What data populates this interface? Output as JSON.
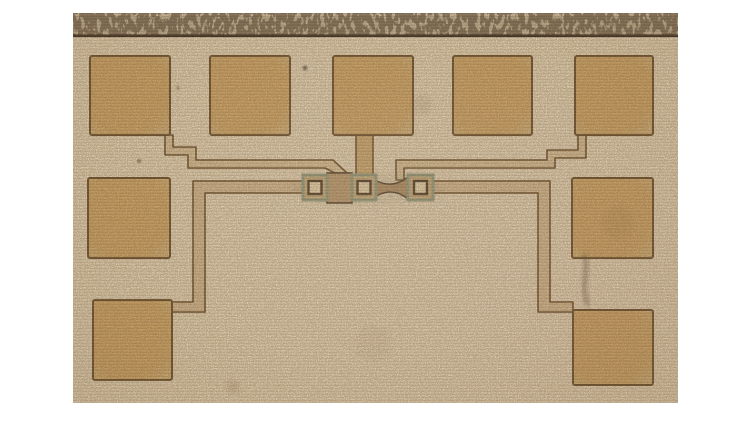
{
  "image": {
    "kind": "photomicrograph",
    "subject": "semiconductor-die-test-structure"
  },
  "photo": {
    "x": 73,
    "y": 13,
    "width": 605,
    "height": 390,
    "colors": {
      "page_bg": "#ffffff",
      "surface": "#dcc9ab",
      "strip": "#bcab8e",
      "strip_speckle": "#574430",
      "strip_highlight": "#d8caae",
      "edge_line": "#2b1e12",
      "pad_fill": "#c89f62",
      "pad_fill_edge": "#c9ab76",
      "pad_border": "#6b4f2c",
      "trace_fill": "#cfb68f",
      "trace_border": "#6b4f2c",
      "loop_fill": "#ccb189",
      "tab_fill": "#c2a06a",
      "gate_fill": "#b3946a",
      "gate_border": "#55422c",
      "bowtie_fill": "#a8875f",
      "contact_frame": "#8e9377",
      "contact_fill": "#c0a476",
      "contact_inner_border": "#4e3c27",
      "contact_inner_fill": "#dbc9a2",
      "grain": "#6b5334",
      "tint_green": "#8a8a66",
      "stain": "#564734"
    }
  },
  "strip": {
    "h": 22,
    "line_y": 21.5,
    "line_h": 2.6
  },
  "pads": [
    {
      "name": "pad-top-1",
      "x": 17,
      "y": 43,
      "w": 80,
      "h": 79
    },
    {
      "name": "pad-top-2",
      "x": 137,
      "y": 43,
      "w": 80,
      "h": 79
    },
    {
      "name": "pad-top-3",
      "x": 260,
      "y": 43,
      "w": 80,
      "h": 79
    },
    {
      "name": "pad-top-4",
      "x": 380,
      "y": 43,
      "w": 79,
      "h": 79
    },
    {
      "name": "pad-top-5",
      "x": 502,
      "y": 43,
      "w": 78,
      "h": 79
    },
    {
      "name": "pad-mid-left",
      "x": 15,
      "y": 165,
      "w": 82,
      "h": 80
    },
    {
      "name": "pad-mid-right",
      "x": 499,
      "y": 165,
      "w": 81,
      "h": 80
    },
    {
      "name": "pad-bottom-left",
      "x": 20,
      "y": 287,
      "w": 79,
      "h": 80
    },
    {
      "name": "pad-bottom-right",
      "x": 500,
      "y": 297,
      "w": 80,
      "h": 75
    }
  ],
  "traces": [
    {
      "name": "gate-feed-left",
      "kind": "trace",
      "d": "M92,122 L100,122 L100,134 L123,134 L123,147 L260,147 L274,160 L262,160 L252,155 L115,155 L115,142 L92,142 Z"
    },
    {
      "name": "gate-feed-right",
      "kind": "trace",
      "d": "M513,122 L513,145 L482,145 L482,155 L331,155 L331,167 L323,167 L323,147 L474,147 L474,137 L505,137 L505,122 Z"
    },
    {
      "name": "loop-left-arm",
      "kind": "loop",
      "d": "M230,168 L120,168 L120,289 L99,289 L99,299 L132,299 L132,180 L230,180 Z"
    },
    {
      "name": "loop-right-arm",
      "kind": "loop",
      "d": "M360,168 L477,168 L477,289 L500,289 L500,299 L465,299 L465,180 L360,180 Z"
    },
    {
      "name": "center-feed-tab",
      "kind": "tab",
      "d": "M283,120 L300,120 L300,164 L283,164 Z"
    }
  ],
  "device": {
    "gate_bar": {
      "x": 254,
      "y": 160,
      "w": 25,
      "h": 30
    },
    "bowtie_d": "M300,166 C312,173 324,173 335,164 L335,186 C324,177 312,177 300,185 Z",
    "contacts": [
      {
        "x": 230,
        "y": 162,
        "w": 24,
        "h": 25
      },
      {
        "x": 279,
        "y": 162,
        "w": 24,
        "h": 25
      },
      {
        "x": 335,
        "y": 162,
        "w": 25,
        "h": 25
      }
    ],
    "tint": {
      "cx": 295,
      "cy": 176,
      "rx": 78,
      "ry": 15
    }
  },
  "stains": [
    {
      "name": "speck",
      "type": "dot",
      "cx": 232,
      "cy": 55,
      "r": 2.3,
      "opacity": 0.75
    },
    {
      "name": "speck",
      "type": "dot",
      "cx": 105,
      "cy": 75,
      "r": 1.6,
      "opacity": 0.5
    },
    {
      "name": "speck",
      "type": "dot",
      "cx": 66,
      "cy": 148,
      "r": 2.0,
      "opacity": 0.6
    },
    {
      "name": "smudge-streak",
      "type": "streak",
      "d": "M511,243 C518,258 505,272 515,291",
      "width": 5.5,
      "opacity": 0.38
    },
    {
      "name": "blotch",
      "type": "blob",
      "cx": 349,
      "cy": 92,
      "r": 10,
      "opacity": 0.1
    },
    {
      "name": "blotch",
      "type": "blob",
      "cx": 160,
      "cy": 374,
      "r": 7,
      "opacity": 0.14
    },
    {
      "name": "blotch",
      "type": "blob",
      "cx": 545,
      "cy": 210,
      "r": 16,
      "opacity": 0.08
    },
    {
      "name": "blotch",
      "type": "blob",
      "cx": 300,
      "cy": 330,
      "r": 18,
      "opacity": 0.05
    }
  ]
}
